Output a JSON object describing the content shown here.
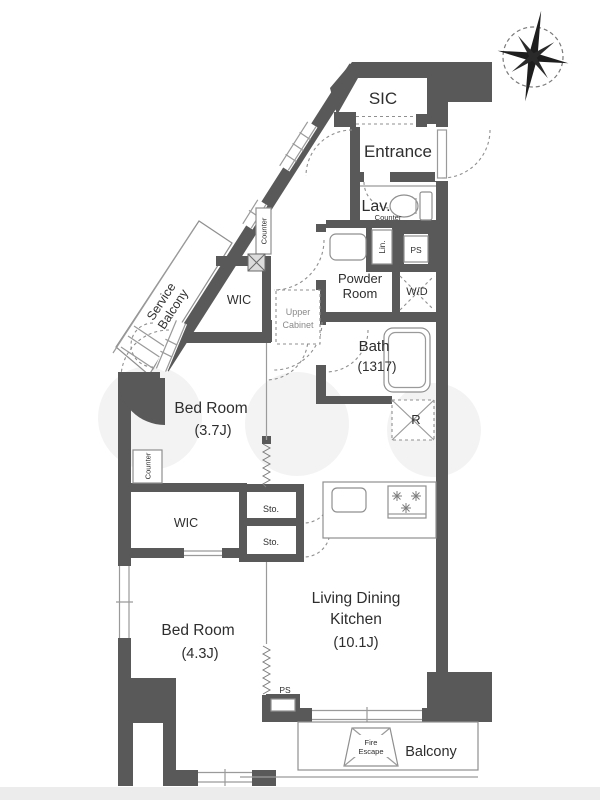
{
  "plan": {
    "type": "apartment-floor-plan",
    "colors": {
      "wall": "#595959",
      "thin_line": "#9a9a9a",
      "dashed_line": "#8f8f8f",
      "text": "#2e2e2e",
      "muted_text": "#8a8a8a",
      "background": "#ffffff",
      "bottom_strip": "#ececec"
    },
    "compass": {
      "icon": "compass-rose"
    },
    "rooms": {
      "sic": "SIC",
      "entrance": "Entrance",
      "lav": "Lav.",
      "lav_counter": "Counter",
      "lin": "Lin.",
      "ps_upper": "PS",
      "powder_line1": "Powder",
      "powder_line2": "Room",
      "wd": "W/D",
      "bath": "Bath",
      "bath_size": "(1317)",
      "fridge": "R",
      "wic_upper": "WIC",
      "upper_cabinet_line1": "Upper",
      "upper_cabinet_line2": "Cabinet",
      "counter_upper": "Counter",
      "service_balcony_line1": "Service",
      "service_balcony_line2": "Balcony",
      "bedroom1": "Bed Room",
      "bedroom1_size": "(3.7J)",
      "counter_lower": "Counter",
      "wic_lower": "WIC",
      "sto_upper": "Sto.",
      "sto_lower": "Sto.",
      "bedroom2": "Bed Room",
      "bedroom2_size": "(4.3J)",
      "ldk_line1": "Living Dining",
      "ldk_line2": "Kitchen",
      "ldk_size": "(10.1J)",
      "ps_lower": "PS",
      "fire_escape_line1": "Fire",
      "fire_escape_line2": "Escape",
      "balcony": "Balcony"
    }
  }
}
